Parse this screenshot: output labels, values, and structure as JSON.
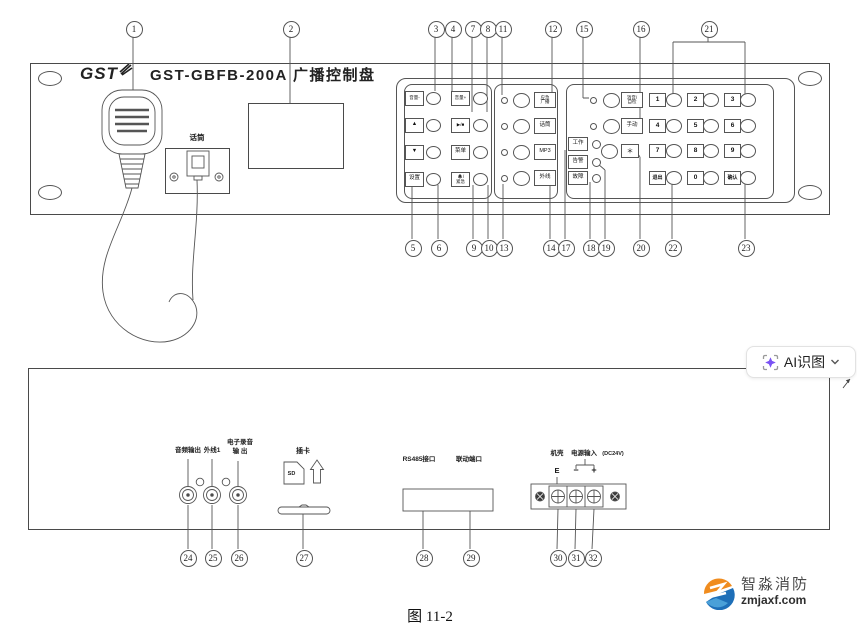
{
  "figure": {
    "caption": "图 11-2"
  },
  "overlay": {
    "ai_button_label": "AI识图"
  },
  "front": {
    "brand": "GST",
    "title": "GST-GBFB-200A 广播控制盘",
    "mic_jack_label": "话筒",
    "keys_left": [
      {
        "label": "音量-"
      },
      {
        "label": "音量+"
      },
      {
        "label": "▲"
      },
      {
        "label": "▶/■"
      },
      {
        "label": "▼"
      },
      {
        "label": "菜单"
      },
      {
        "label": "设置"
      },
      {
        "label": "紧急",
        "icon": "bell-icon"
      }
    ],
    "channels": [
      {
        "line1": "应急",
        "line2": "广播"
      },
      {
        "label": "话筒"
      },
      {
        "label": "MP3"
      },
      {
        "label": "外线"
      }
    ],
    "keys_right": [
      {
        "line1": "消音/",
        "line2": "自检"
      },
      {
        "label": "手动"
      }
    ],
    "status_leds": [
      "工作",
      "告警",
      "故障"
    ],
    "star_key": "＊",
    "numpad": [
      "1",
      "2",
      "3",
      "4",
      "5",
      "6",
      "7",
      "8",
      "9",
      "退出",
      "0",
      "确认"
    ]
  },
  "rear": {
    "jack_labels": [
      {
        "line1": "音频输出"
      },
      {
        "line1": "外线1"
      },
      {
        "line1": "电子录音",
        "line2": "输  出"
      }
    ],
    "card": {
      "label": "插卡",
      "sd": "SD"
    },
    "port_labels": [
      "RS485接口",
      "联动端口"
    ],
    "power": {
      "chassis": "机壳",
      "e": "E",
      "input": "电源输入",
      "spec": "(DC24V)",
      "minus": "−",
      "plus": "+"
    }
  },
  "callouts": {
    "top": [
      "1",
      "2",
      "3",
      "4",
      "7",
      "8",
      "11",
      "12",
      "15",
      "16",
      "21"
    ],
    "bottom": [
      "5",
      "6",
      "9",
      "10",
      "13",
      "14",
      "17",
      "18",
      "19",
      "20",
      "22",
      "23"
    ],
    "rear": [
      "24",
      "25",
      "26",
      "27",
      "28",
      "29",
      "30",
      "31",
      "32"
    ]
  },
  "watermark": {
    "name": "智淼消防",
    "site": "zmjaxf.com"
  },
  "colors": {
    "accent_purple": "#7a52f4",
    "logo_orange": "#f08c1e",
    "logo_blue": "#1e6fb8"
  }
}
